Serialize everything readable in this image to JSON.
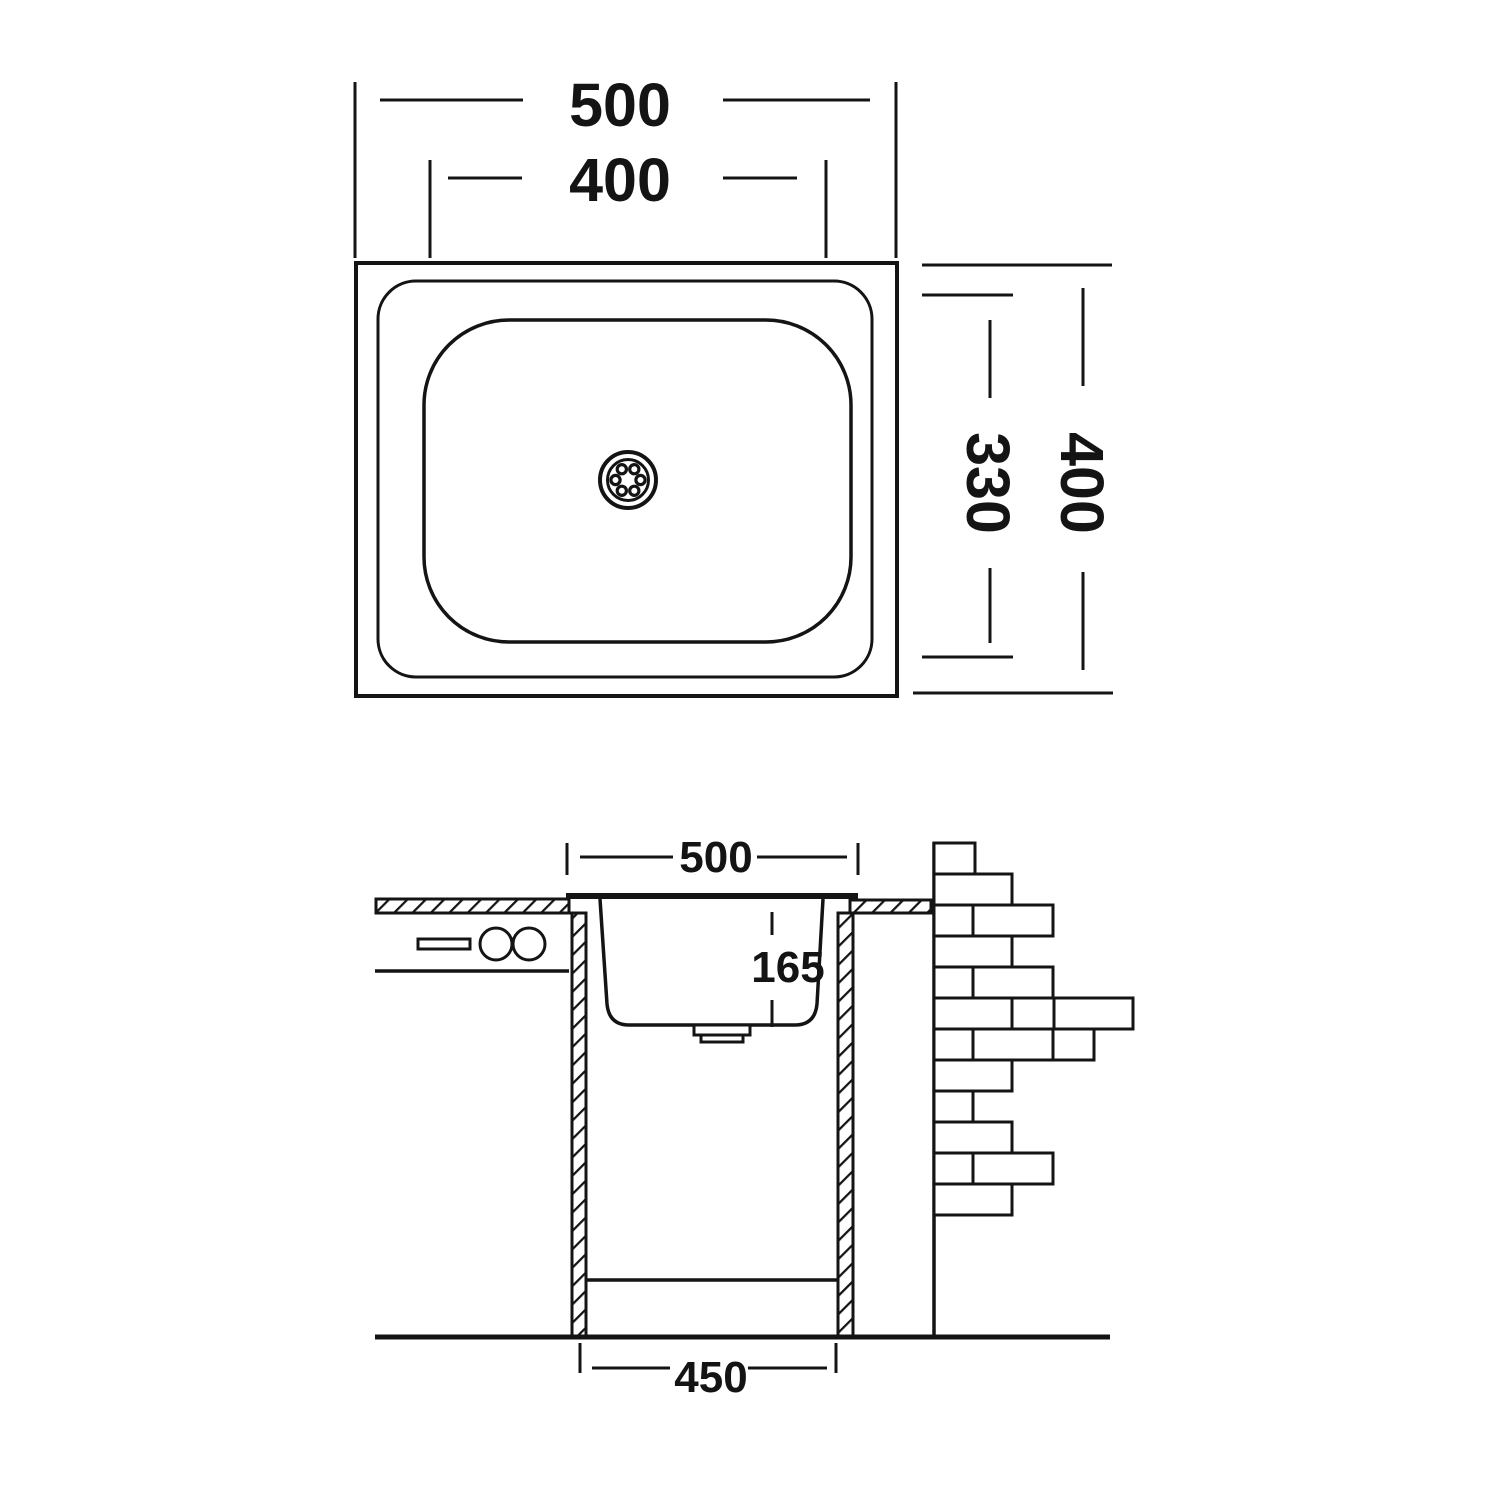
{
  "colors": {
    "line": "#141414",
    "background": "#ffffff"
  },
  "top_view": {
    "outer_width_mm": "500",
    "inner_width_mm": "400",
    "outer_depth_mm": "400",
    "inner_depth_mm": "330"
  },
  "section_view": {
    "opening_width_mm": "500",
    "bowl_depth_mm": "165",
    "base_width_mm": "450"
  }
}
